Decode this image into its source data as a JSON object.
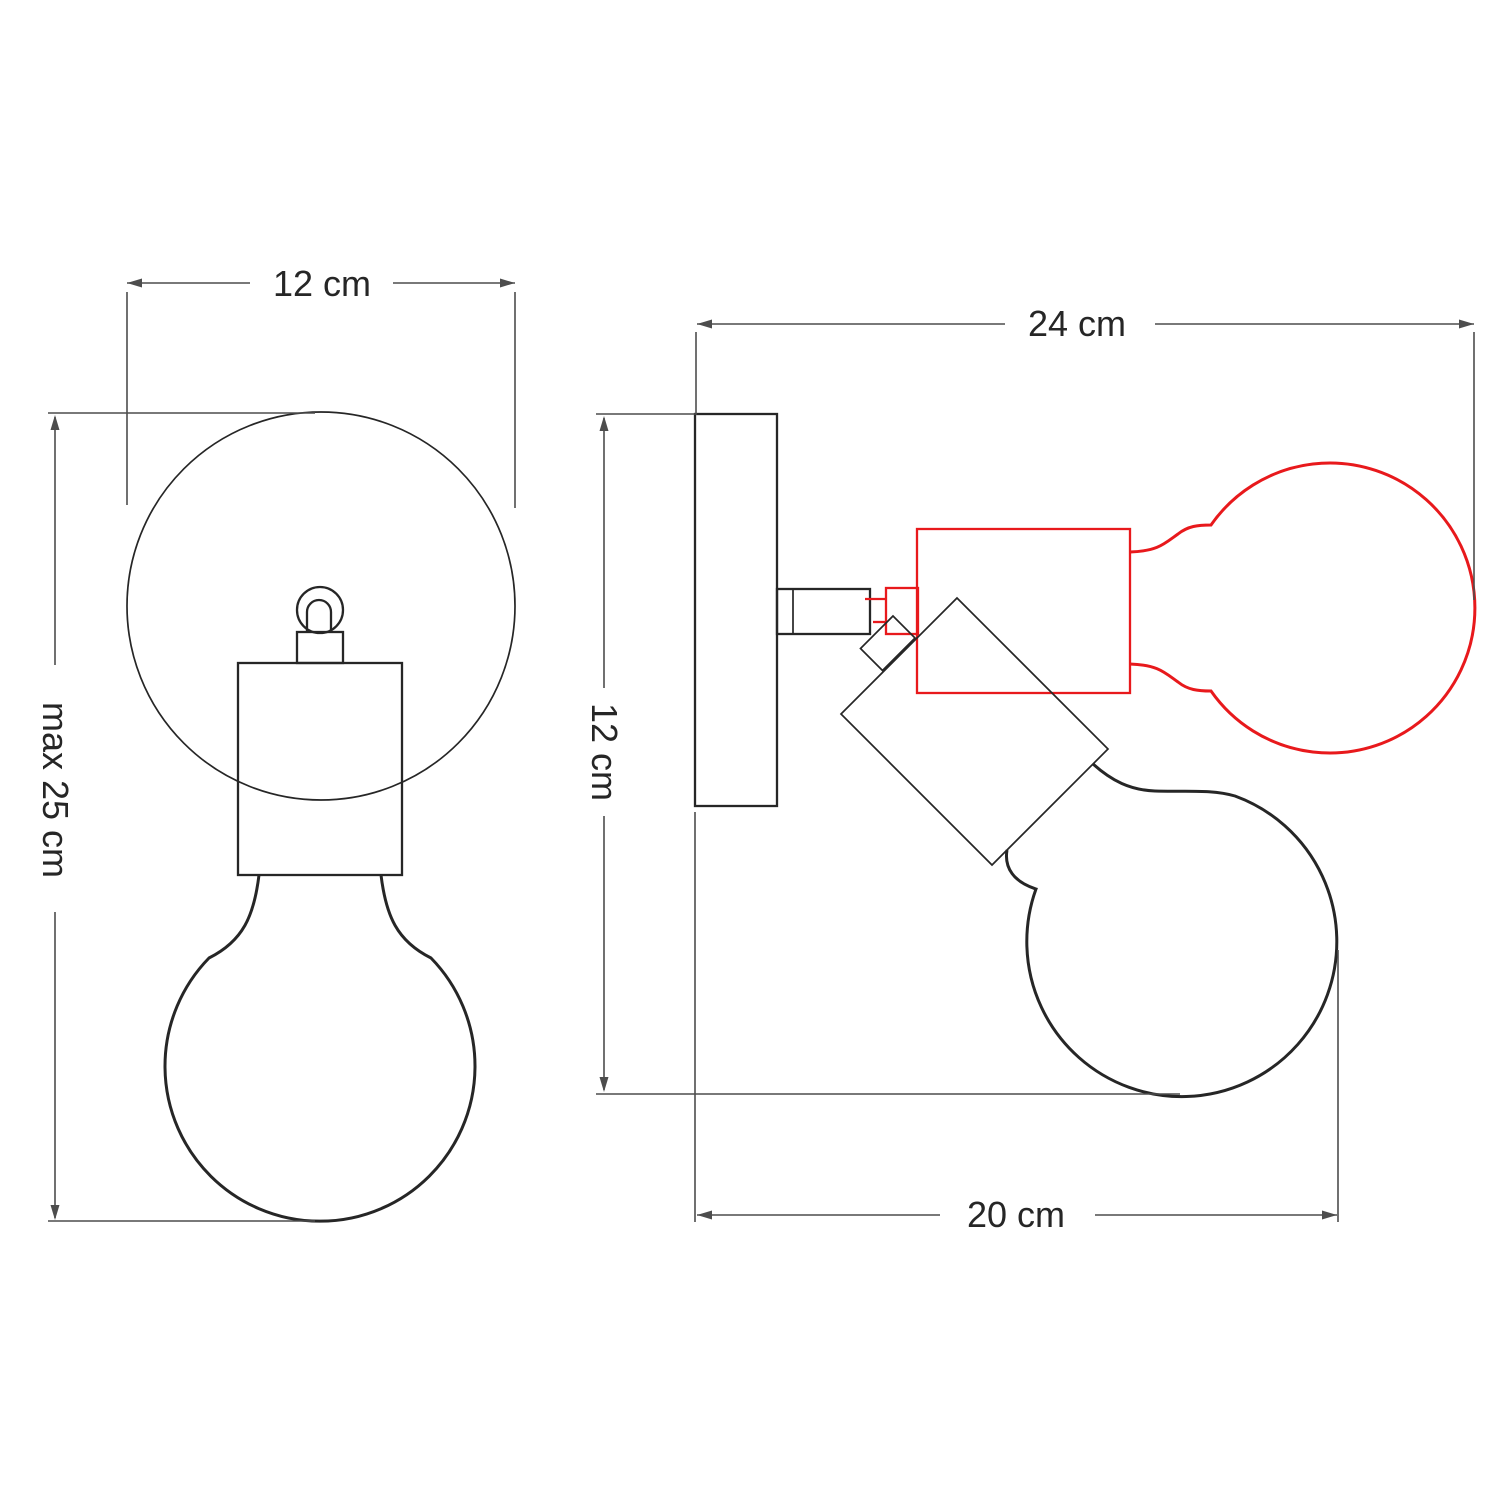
{
  "drawing": {
    "title": "Adjustable wall lamp dimension drawing",
    "views": {
      "front": "front view",
      "side": "side view with tilted position"
    }
  },
  "dimensions": {
    "front_width": "12 cm",
    "front_height": "max 25 cm",
    "side_width": "24 cm",
    "side_height": "12 cm",
    "side_reach": "20 cm"
  },
  "colors": {
    "outline": "#262626",
    "dimension": "#4d4d4d",
    "alternate_position": "#e8191c",
    "background": "#ffffff"
  }
}
